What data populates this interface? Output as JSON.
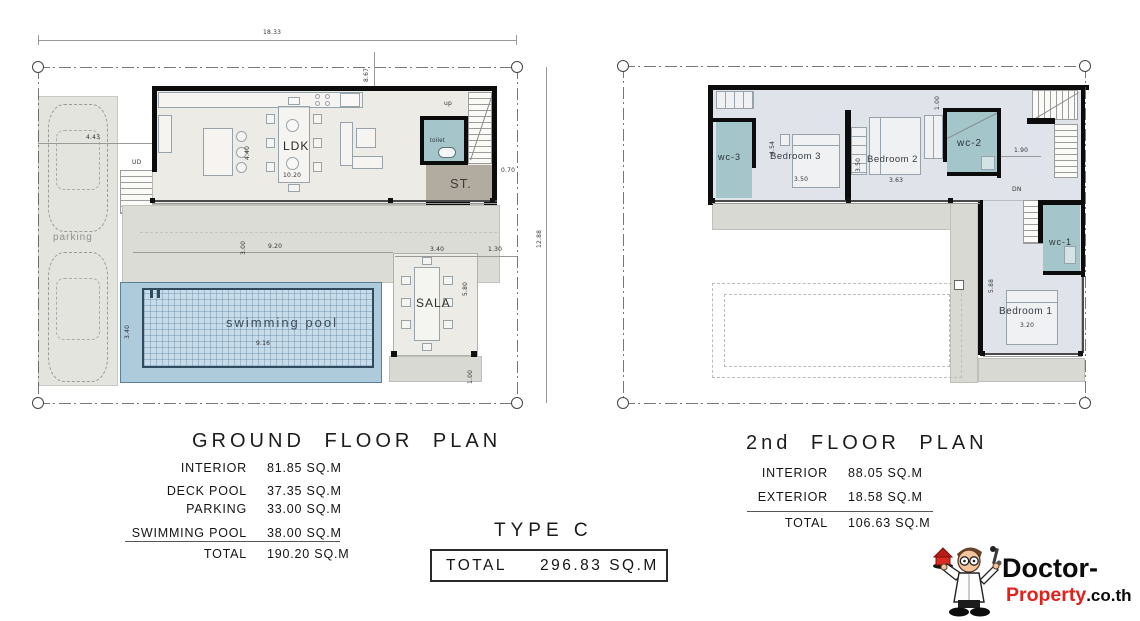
{
  "ground_floor": {
    "title": "GROUND FLOOR PLAN",
    "labels": {
      "parking": "parking",
      "ldk": "LDK",
      "toilet": "toilet",
      "storage": "ST.",
      "sala": "SALA",
      "pool": "swimming pool",
      "up": "up",
      "entry": "UD"
    },
    "dims": {
      "overall_w": "18.33",
      "wing_offset": "8.67",
      "parking_w": "4.43",
      "ldk_d": "4.40",
      "ldk_w": "10.20",
      "st_off": "0.70",
      "overall_d": "12.88",
      "deck_d": "3.00",
      "deck_w": "9.20",
      "pool_d": "3.40",
      "pool_w": "9.16",
      "sala_w": "3.40",
      "sala_off": "1.30",
      "sala_d": "5.80",
      "sala_deck": "1.00"
    },
    "table": {
      "rows": [
        {
          "label": "INTERIOR",
          "value": "81.85 SQ.M"
        },
        {
          "label": "DECK POOL",
          "value": "37.35 SQ.M"
        },
        {
          "label": "PARKING",
          "value": "33.00 SQ.M"
        },
        {
          "label": "SWIMMING POOL",
          "value": "38.00 SQ.M"
        }
      ],
      "total_label": "TOTAL",
      "total_value": "190.20 SQ.M"
    }
  },
  "second_floor": {
    "title": "2nd FLOOR PLAN",
    "labels": {
      "wc3": "wc-3",
      "bedroom3": "Bedroom 3",
      "bedroom2": "Bedroom 2",
      "wc2": "wc-2",
      "wc1": "wc-1",
      "bedroom1": "Bedroom 1",
      "down": "DN"
    },
    "dims": {
      "b3_d": "4.54",
      "b3_w": "3.50",
      "b2_d": "3.50",
      "b2_w": "3.63",
      "hall_w": "1.90",
      "top_off": "1.00",
      "b1_w": "3.20",
      "b1_d": "5.88"
    },
    "table": {
      "rows": [
        {
          "label": "INTERIOR",
          "value": "88.05 SQ.M"
        },
        {
          "label": "EXTERIOR",
          "value": "18.58 SQ.M"
        }
      ],
      "total_label": "TOTAL",
      "total_value": "106.63 SQ.M"
    }
  },
  "summary": {
    "type_label": "TYPE C",
    "total_label": "TOTAL",
    "total_value": "296.83 SQ.M"
  },
  "logo": {
    "word1": "Doctor-",
    "word2": "Property",
    "word3": ".co.th"
  },
  "colors": {
    "wall": "#0c0c0c",
    "wet_room": "#a4c5c9",
    "pool": "#c7dbe8",
    "deck": "#dcdcd6",
    "floor_gf": "#edebe6",
    "floor_2f": "#e0e4ea",
    "storage": "#b2aba0",
    "logo_red": "#e3201b"
  }
}
